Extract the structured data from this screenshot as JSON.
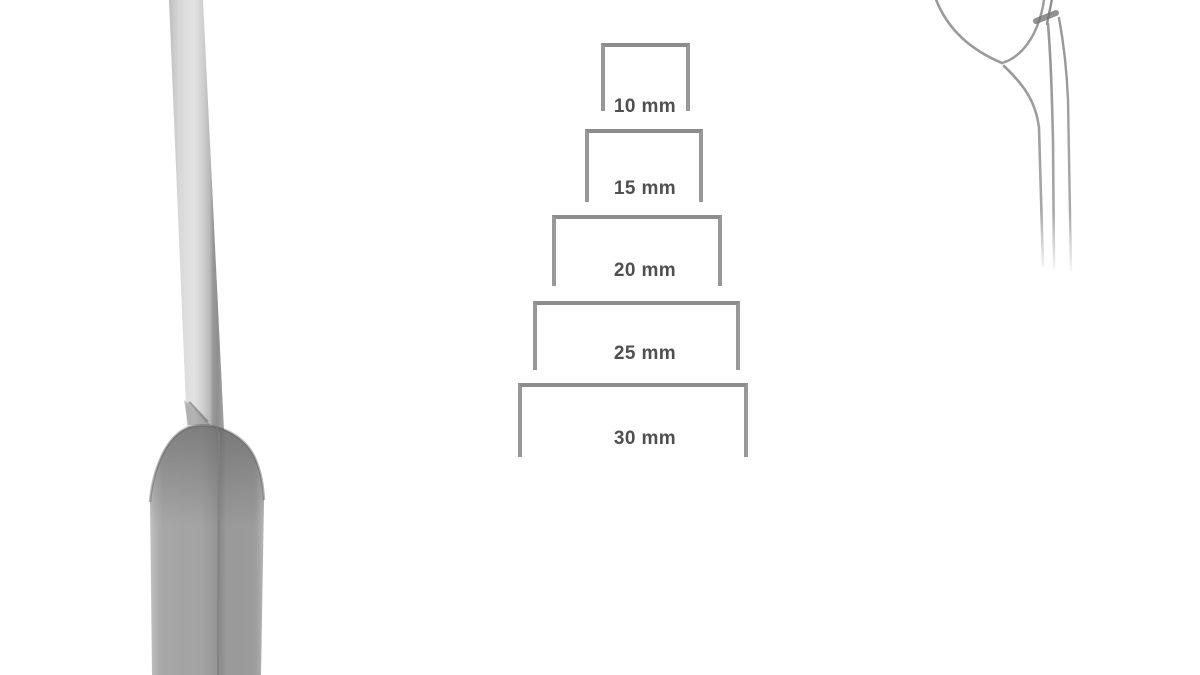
{
  "diagram": {
    "sizes": [
      {
        "label": "10 mm"
      },
      {
        "label": "15 mm"
      },
      {
        "label": "20 mm"
      },
      {
        "label": "25 mm"
      },
      {
        "label": "30 mm"
      }
    ]
  },
  "figures": {
    "instrument": "osteotome-chisel-side-view",
    "tip_detail": "curved-blade-tip-outline"
  },
  "colors": {
    "background": "#ffffff",
    "bracket_line": "#8c8c8c",
    "label_text": "#4f4f4f",
    "metal_light": "#e3e3e3",
    "metal_mid": "#a0a0a0",
    "metal_dark": "#8a8a8a",
    "outline_line": "#9a9a9a"
  }
}
